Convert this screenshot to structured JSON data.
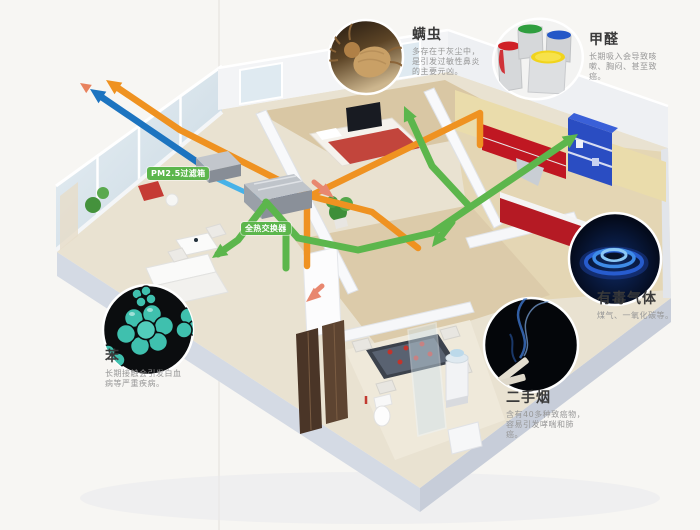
{
  "canvas": {
    "width": 700,
    "height": 530,
    "background": "#f7f6f3"
  },
  "system_labels": {
    "pm25_filter": "PM2.5过滤箱",
    "heat_exchanger": "全热交换器"
  },
  "callouts": [
    {
      "id": "dust-mite",
      "title": "螨虫",
      "desc": "多存在于灰尘中，是引发过敏性鼻炎的主要元凶。",
      "image": "dust-mite-photo"
    },
    {
      "id": "formaldehyde",
      "title": "甲醛",
      "desc": "长期吸入会导致咳嗽、胸闷、甚至致癌。",
      "image": "paint-buckets-photo"
    },
    {
      "id": "benzene",
      "title": "苯",
      "desc": "长期接触会引发白血病等严重疾病。",
      "image": "benzene-molecule-photo"
    },
    {
      "id": "toxic-gas",
      "title": "有毒气体",
      "desc": "煤气、一氧化碳等。",
      "image": "gas-flame-photo"
    },
    {
      "id": "secondhand-smoke",
      "title": "二手烟",
      "desc": "含有40多种致癌物，容易引发哮喘和肺癌。",
      "image": "cigarette-smoke-photo"
    }
  ],
  "colors": {
    "fresh_air_duct": "#1d74c0",
    "filtered_air_duct": "#47b2e8",
    "supply_duct": "#5cb64c",
    "exhaust_duct": "#ef9221",
    "room_air_arrow": "#e8876f",
    "label_background": "#5cb64c",
    "callout_title": "#3a3a3a",
    "callout_desc": "#979797"
  }
}
